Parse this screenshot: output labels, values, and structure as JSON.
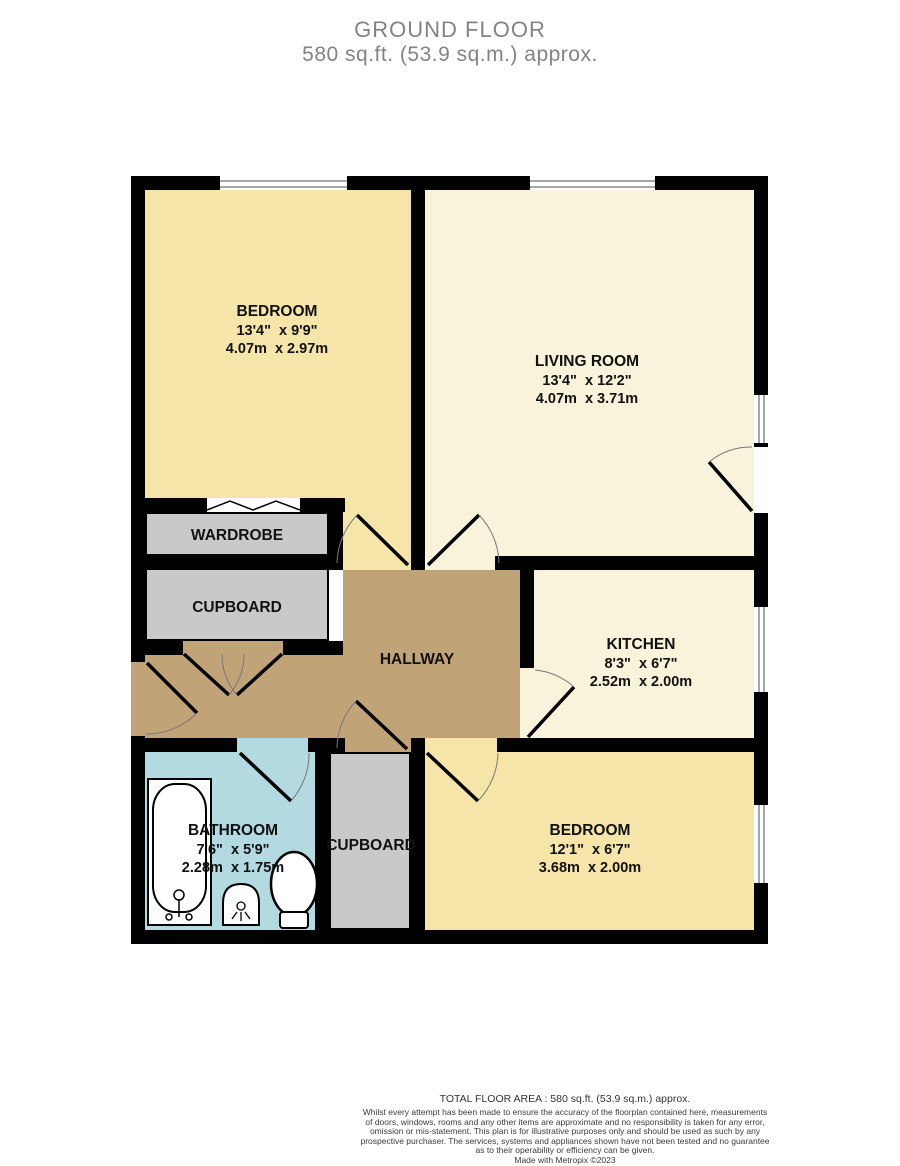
{
  "header": {
    "title": "GROUND FLOOR",
    "subtitle": "580 sq.ft. (53.9 sq.m.) approx."
  },
  "rooms": {
    "bedroom1": {
      "name": "BEDROOM",
      "imperial": "13'4\"  x 9'9\"",
      "metric": "4.07m  x 2.97m"
    },
    "living": {
      "name": "LIVING ROOM",
      "imperial": "13'4\"  x 12'2\"",
      "metric": "4.07m  x 3.71m"
    },
    "kitchen": {
      "name": "KITCHEN",
      "imperial": "8'3\"  x 6'7\"",
      "metric": "2.52m  x 2.00m"
    },
    "bedroom2": {
      "name": "BEDROOM",
      "imperial": "12'1\"  x 6'7\"",
      "metric": "3.68m  x 2.00m"
    },
    "bathroom": {
      "name": "BATHROOM",
      "imperial": "7'6\"  x 5'9\"",
      "metric": "2.28m  x 1.75m"
    },
    "hallway": {
      "name": "HALLWAY"
    },
    "wardrobe": {
      "name": "WARDROBE"
    },
    "cupboard_hall": {
      "name": "CUPBOARD"
    },
    "cupboard_lower": {
      "name": "CUPBOARD"
    }
  },
  "footer": {
    "total": "TOTAL FLOOR AREA : 580 sq.ft. (53.9 sq.m.) approx.",
    "disclaimer_lines": [
      "Whilst every attempt has been made to ensure the accuracy of the floorplan contained here, measurements",
      "of doors, windows, rooms and any other items are approximate and no responsibility is taken for any error,",
      "omission or mis-statement. This plan is for illustrative purposes only and should be used as such by any",
      "prospective purchaser. The services, systems and appliances shown have not been tested and no guarantee",
      "as to their operability or efficiency can be given."
    ],
    "made": "Made with Metropix ©2023"
  },
  "colors": {
    "bedroom_fill": "#F6E5A9",
    "living_fill": "#FAF3DC",
    "hallway_fill": "#C1A378",
    "bathroom_fill": "#B3D9E1",
    "storage_fill": "#C9C9C9",
    "wall": "#000000"
  }
}
